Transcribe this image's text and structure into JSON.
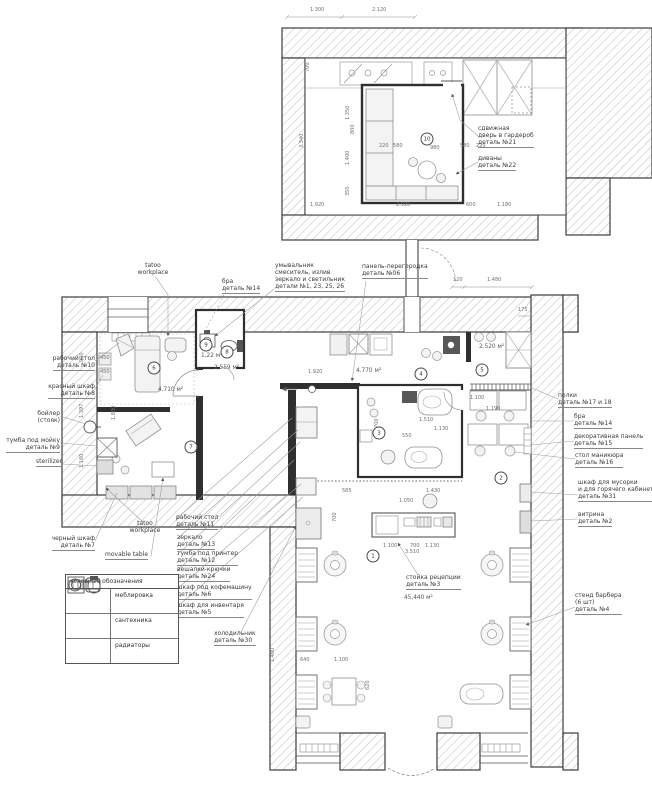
{
  "sheet": {
    "kind": "barbershop floor plan working drawing"
  },
  "colors": {
    "line": "#3d3d3d",
    "wall_hatch": "#c2c2c2",
    "interior_wall": "#2f2f2f",
    "furniture": "#8f8f8f",
    "text": "#3b3b3b",
    "leader": "#9a9a9a",
    "paper": "#ffffff"
  },
  "legend": {
    "title": "условные обозначения",
    "rows": [
      {
        "label": "меблировка",
        "icon": "furniture-icon"
      },
      {
        "label": "сантехника",
        "icon": "plumbing-icon"
      },
      {
        "label": "радиаторы",
        "icon": "radiator-icon"
      }
    ]
  },
  "labels": [
    {
      "x": 95,
      "y": 355,
      "a": "r",
      "lines": [
        {
          "t": "рабочий стол"
        },
        {
          "t": "деталь №10",
          "u": 1
        }
      ]
    },
    {
      "x": 95,
      "y": 383,
      "a": "r",
      "lines": [
        {
          "t": "красный шкаф"
        },
        {
          "t": "деталь №8",
          "u": 1
        }
      ]
    },
    {
      "x": 60,
      "y": 410,
      "a": "r",
      "lines": [
        {
          "t": "бойлер"
        },
        {
          "t": "(стояк)"
        }
      ]
    },
    {
      "x": 60,
      "y": 437,
      "a": "r",
      "lines": [
        {
          "t": "тумба под мойку"
        },
        {
          "t": "деталь №9",
          "u": 1
        }
      ]
    },
    {
      "x": 62,
      "y": 458,
      "a": "r",
      "lines": [
        {
          "t": "sterilizer",
          "u": 1
        }
      ]
    },
    {
      "x": 95,
      "y": 535,
      "a": "r",
      "lines": [
        {
          "t": "черный шкаф"
        },
        {
          "t": "деталь №7",
          "u": 1
        }
      ]
    },
    {
      "x": 153,
      "y": 262,
      "a": "c",
      "lines": [
        {
          "t": "tatoo"
        },
        {
          "t": "workplace"
        }
      ]
    },
    {
      "x": 222,
      "y": 278,
      "a": "l",
      "lines": [
        {
          "t": "бра"
        },
        {
          "t": "деталь №14",
          "u": 1
        }
      ]
    },
    {
      "x": 275,
      "y": 262,
      "a": "l",
      "lines": [
        {
          "t": "умывальник"
        },
        {
          "t": "смеситель, излив"
        },
        {
          "t": "зеркало и светильник"
        },
        {
          "t": "детали №1, 23, 25, 26",
          "u": 1
        }
      ]
    },
    {
      "x": 362,
      "y": 263,
      "a": "l",
      "lines": [
        {
          "t": "панель-перегородка"
        },
        {
          "t": "деталь №06",
          "u": 1
        }
      ]
    },
    {
      "x": 558,
      "y": 392,
      "a": "l",
      "lines": [
        {
          "t": "полки"
        },
        {
          "t": "деталь №17 и 18",
          "u": 1
        }
      ]
    },
    {
      "x": 574,
      "y": 413,
      "a": "l",
      "lines": [
        {
          "t": "бра"
        },
        {
          "t": "деталь №14",
          "u": 1
        }
      ]
    },
    {
      "x": 574,
      "y": 433,
      "a": "l",
      "lines": [
        {
          "t": "декоративная панель"
        },
        {
          "t": "деталь №15",
          "u": 1
        }
      ]
    },
    {
      "x": 575,
      "y": 452,
      "a": "l",
      "lines": [
        {
          "t": "стол маникюра"
        },
        {
          "t": "деталь №16",
          "u": 1
        }
      ]
    },
    {
      "x": 578,
      "y": 479,
      "a": "l",
      "lines": [
        {
          "t": "шкаф для мусорки"
        },
        {
          "t": "и для горячего кабинета"
        },
        {
          "t": "деталь №31",
          "u": 1
        }
      ]
    },
    {
      "x": 578,
      "y": 511,
      "a": "l",
      "lines": [
        {
          "t": "витрина"
        },
        {
          "t": "деталь №2",
          "u": 1
        }
      ]
    },
    {
      "x": 575,
      "y": 592,
      "a": "l",
      "lines": [
        {
          "t": "стенд барбера"
        },
        {
          "t": "(6 шт)"
        },
        {
          "t": "деталь №4",
          "u": 1
        }
      ]
    },
    {
      "x": 176,
      "y": 514,
      "a": "l",
      "lines": [
        {
          "t": "рабочий стол"
        },
        {
          "t": "деталь №11",
          "u": 1
        }
      ]
    },
    {
      "x": 177,
      "y": 534,
      "a": "l",
      "lines": [
        {
          "t": "зеркало"
        },
        {
          "t": "деталь №13",
          "u": 1
        }
      ]
    },
    {
      "x": 177,
      "y": 550,
      "a": "l",
      "lines": [
        {
          "t": "тумба под принтер"
        },
        {
          "t": "деталь №12",
          "u": 1
        }
      ]
    },
    {
      "x": 177,
      "y": 566,
      "a": "l",
      "lines": [
        {
          "t": "вешалки-крючки"
        },
        {
          "t": "деталь №24",
          "u": 1
        }
      ]
    },
    {
      "x": 177,
      "y": 584,
      "a": "l",
      "lines": [
        {
          "t": "шкаф под кофемашину"
        },
        {
          "t": "деталь №6",
          "u": 1
        }
      ]
    },
    {
      "x": 177,
      "y": 602,
      "a": "l",
      "lines": [
        {
          "t": "шкаф для инвентаря"
        },
        {
          "t": "деталь №5",
          "u": 1
        }
      ]
    },
    {
      "x": 145,
      "y": 520,
      "a": "c",
      "lines": [
        {
          "t": "tatoo"
        },
        {
          "t": "workplace"
        }
      ]
    },
    {
      "x": 105,
      "y": 551,
      "a": "l",
      "lines": [
        {
          "t": "movable table",
          "u": 1
        }
      ]
    },
    {
      "x": 214,
      "y": 630,
      "a": "l",
      "lines": [
        {
          "t": "холодильник"
        },
        {
          "t": "деталь №30",
          "u": 1
        }
      ]
    },
    {
      "x": 406,
      "y": 574,
      "a": "l",
      "lines": [
        {
          "t": "стойка рецепции"
        },
        {
          "t": "деталь №3",
          "u": 1
        }
      ]
    },
    {
      "x": 478,
      "y": 125,
      "a": "l",
      "lines": [
        {
          "t": "сдвижная"
        },
        {
          "t": "дверь в гардероб"
        },
        {
          "t": "деталь №21",
          "u": 1
        }
      ]
    },
    {
      "x": 478,
      "y": 155,
      "a": "l",
      "lines": [
        {
          "t": "диваны"
        },
        {
          "t": "деталь №22",
          "u": 1
        }
      ]
    }
  ],
  "dims": [
    {
      "t": "1.300",
      "x": 310,
      "y": 8
    },
    {
      "t": "2.120",
      "x": 372,
      "y": 8
    },
    {
      "t": "700",
      "x": 306,
      "y": 72,
      "r": 1
    },
    {
      "t": "3.340",
      "x": 300,
      "y": 148,
      "r": 1
    },
    {
      "t": "1.350",
      "x": 346,
      "y": 120,
      "r": 1
    },
    {
      "t": "800",
      "x": 351,
      "y": 134,
      "r": 1
    },
    {
      "t": "1.400",
      "x": 346,
      "y": 165,
      "r": 1
    },
    {
      "t": "350",
      "x": 346,
      "y": 196,
      "r": 1
    },
    {
      "t": "220",
      "x": 379,
      "y": 144
    },
    {
      "t": "580",
      "x": 393,
      "y": 144
    },
    {
      "t": "980",
      "x": 430,
      "y": 146
    },
    {
      "t": "580",
      "x": 460,
      "y": 144
    },
    {
      "t": "220",
      "x": 476,
      "y": 144
    },
    {
      "t": "1.920",
      "x": 310,
      "y": 203
    },
    {
      "t": "2.920",
      "x": 396,
      "y": 203
    },
    {
      "t": "600",
      "x": 466,
      "y": 203
    },
    {
      "t": "1.180",
      "x": 497,
      "y": 203
    },
    {
      "t": "120",
      "x": 453,
      "y": 278
    },
    {
      "t": "1.480",
      "x": 487,
      "y": 278
    },
    {
      "t": "175",
      "x": 518,
      "y": 308
    },
    {
      "t": "900",
      "x": 80,
      "y": 362,
      "r": 1
    },
    {
      "t": "1.397",
      "x": 80,
      "y": 418,
      "r": 1
    },
    {
      "t": "1.160",
      "x": 80,
      "y": 468,
      "r": 1
    },
    {
      "t": "450",
      "x": 100,
      "y": 356
    },
    {
      "t": "450",
      "x": 100,
      "y": 370
    },
    {
      "t": "1.800",
      "x": 112,
      "y": 420,
      "r": 1
    },
    {
      "t": "1.920",
      "x": 308,
      "y": 370
    },
    {
      "t": "1.510",
      "x": 419,
      "y": 418
    },
    {
      "t": "1.130",
      "x": 434,
      "y": 427
    },
    {
      "t": "550",
      "x": 402,
      "y": 434
    },
    {
      "t": "700",
      "x": 375,
      "y": 428,
      "r": 1
    },
    {
      "t": "1.100",
      "x": 470,
      "y": 396
    },
    {
      "t": "1.190",
      "x": 486,
      "y": 407
    },
    {
      "t": "585",
      "x": 342,
      "y": 489
    },
    {
      "t": "1.430",
      "x": 426,
      "y": 489
    },
    {
      "t": "1.050",
      "x": 399,
      "y": 499
    },
    {
      "t": "1.100",
      "x": 383,
      "y": 544
    },
    {
      "t": "700",
      "x": 410,
      "y": 544
    },
    {
      "t": "1.130",
      "x": 425,
      "y": 544
    },
    {
      "t": "3.510",
      "x": 405,
      "y": 550
    },
    {
      "t": "700",
      "x": 333,
      "y": 522,
      "r": 1
    },
    {
      "t": "640",
      "x": 300,
      "y": 658
    },
    {
      "t": "1.100",
      "x": 334,
      "y": 658
    },
    {
      "t": "620",
      "x": 366,
      "y": 690,
      "r": 1
    },
    {
      "t": "1.480",
      "x": 271,
      "y": 662,
      "r": 1
    }
  ],
  "areas": [
    {
      "t": "4.710 м²",
      "x": 158,
      "y": 388
    },
    {
      "t": "1,22 м²",
      "x": 201,
      "y": 354
    },
    {
      "t": "2.559 м²",
      "x": 214,
      "y": 366
    },
    {
      "t": "4.770 м²",
      "x": 356,
      "y": 369
    },
    {
      "t": "2.520 м²",
      "x": 479,
      "y": 345
    },
    {
      "t": "45,440 м²",
      "x": 404,
      "y": 596
    }
  ],
  "markers": [
    {
      "t": "10",
      "x": 427,
      "y": 139
    },
    {
      "t": "6",
      "x": 154,
      "y": 368
    },
    {
      "t": "7",
      "x": 191,
      "y": 447
    },
    {
      "t": "9",
      "x": 206,
      "y": 345
    },
    {
      "t": "8",
      "x": 227,
      "y": 352
    },
    {
      "t": "4",
      "x": 421,
      "y": 374
    },
    {
      "t": "5",
      "x": 482,
      "y": 370
    },
    {
      "t": "3",
      "x": 379,
      "y": 433
    },
    {
      "t": "2",
      "x": 501,
      "y": 478
    },
    {
      "t": "1",
      "x": 373,
      "y": 556
    }
  ]
}
